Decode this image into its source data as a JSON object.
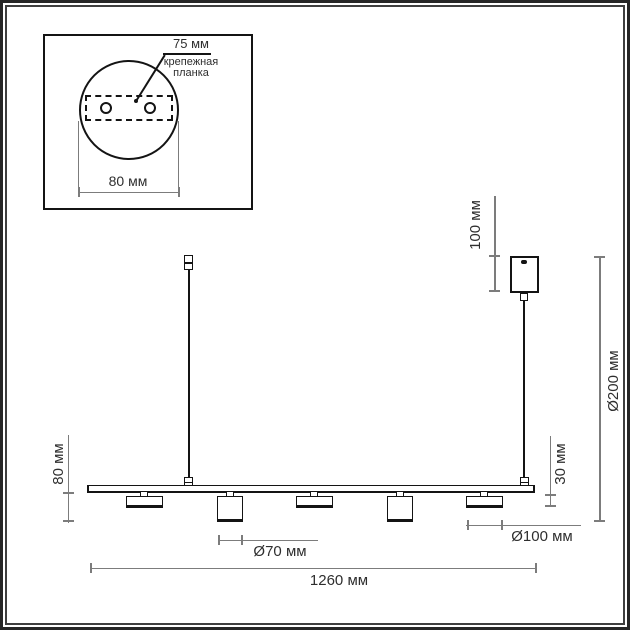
{
  "inset": {
    "top_label": "75 мм",
    "plate_label": "крепежная\nпланка",
    "width_label": "80 мм"
  },
  "dims": {
    "canopy_height": "100 мм",
    "overall_height": "Ø200 мм",
    "spot_front_height": "80 мм",
    "spot_side_height": "30 мм",
    "spot_front_diameter": "Ø70 мм",
    "spot_side_length": "Ø100 мм",
    "bar_length": "1260 мм"
  },
  "colors": {
    "fixture_ink": "#141414",
    "dimension_gray": "#7c7c7c",
    "text": "#2e2e2e",
    "background": "#ffffff",
    "frame": "#3f3f3f"
  }
}
